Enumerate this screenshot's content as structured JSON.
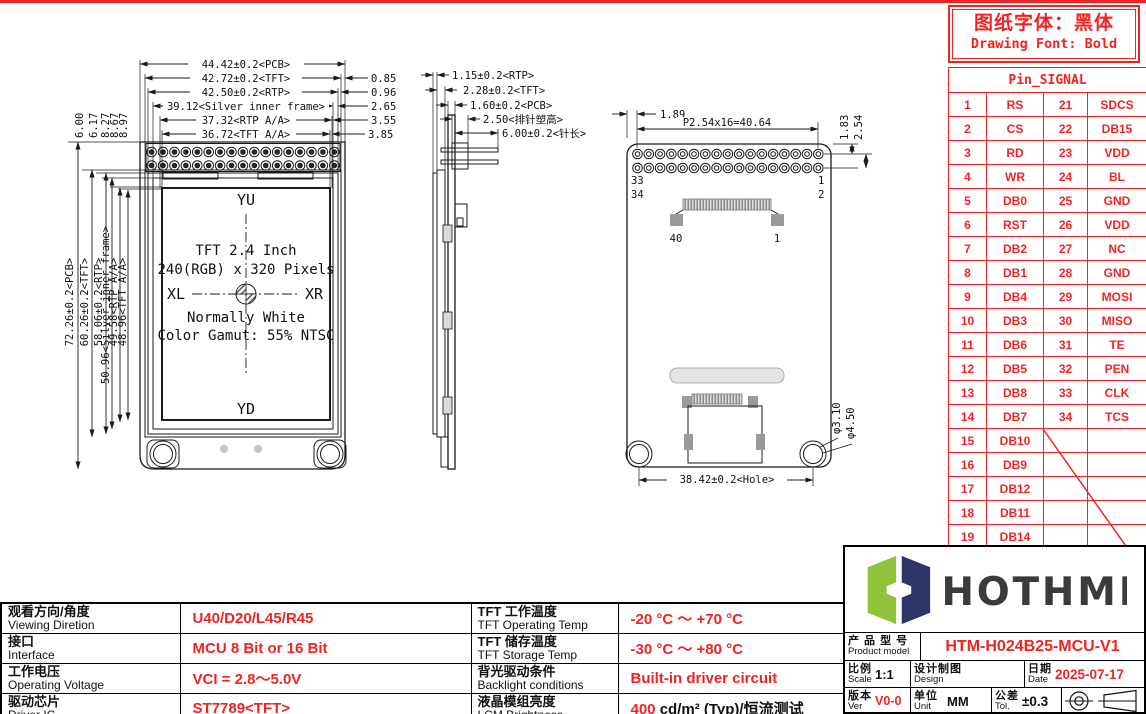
{
  "note_box": {
    "line1": "图纸字体：黑体",
    "line2": "Drawing Font: Bold"
  },
  "pin_table": {
    "title": "Pin_SIGNAL",
    "rows": [
      [
        "1",
        "RS",
        "21",
        "SDCS"
      ],
      [
        "2",
        "CS",
        "22",
        "DB15"
      ],
      [
        "3",
        "RD",
        "23",
        "VDD"
      ],
      [
        "4",
        "WR",
        "24",
        "BL"
      ],
      [
        "5",
        "DB0",
        "25",
        "GND"
      ],
      [
        "6",
        "RST",
        "26",
        "VDD"
      ],
      [
        "7",
        "DB2",
        "27",
        "NC"
      ],
      [
        "8",
        "DB1",
        "28",
        "GND"
      ],
      [
        "9",
        "DB4",
        "29",
        "MOSI"
      ],
      [
        "10",
        "DB3",
        "30",
        "MISO"
      ],
      [
        "11",
        "DB6",
        "31",
        "TE"
      ],
      [
        "12",
        "DB5",
        "32",
        "PEN"
      ],
      [
        "13",
        "DB8",
        "33",
        "CLK"
      ],
      [
        "14",
        "DB7",
        "34",
        "TCS"
      ],
      [
        "15",
        "DB10",
        "",
        ""
      ],
      [
        "16",
        "DB9",
        "",
        ""
      ],
      [
        "17",
        "DB12",
        "",
        ""
      ],
      [
        "18",
        "DB11",
        "",
        ""
      ],
      [
        "19",
        "DB14",
        "",
        ""
      ],
      [
        "20",
        "DB13",
        "",
        ""
      ]
    ]
  },
  "front_view": {
    "dim_pcb_w": "44.42±0.2<PCB>",
    "dim_tft_w": "42.72±0.2<TFT>",
    "dim_rtp_w": "42.50±0.2<RTP>",
    "dim_silver_w": "39.12<Silver inner frame>",
    "dim_rtp_aa_w": "37.32<RTP A/A>",
    "dim_tft_aa_w": "36.72<TFT A/A>",
    "off_tft": "0.85",
    "off_rtp": "0.96",
    "off_silver": "2.65",
    "off_rtp_aa": "3.55",
    "off_tft_aa": "3.85",
    "top_offsets": [
      "6.00",
      "6.17",
      "8.27",
      "8.67",
      "8.97"
    ],
    "dim_pcb_h": "72.26±0.2<PCB>",
    "dim_tft_h": "60.26±0.2<TFT>",
    "dim_rtp_h": "58.06±0.2<RTP>",
    "dim_silver_h": "50.96<Silver inner frame>",
    "dim_rtp_aa_h": "49.58<RTP A/A>",
    "dim_tft_aa_h": "48.96<TFT A/A>",
    "label_yu": "YU",
    "label_yd": "YD",
    "label_xl": "XL",
    "label_xr": "XR",
    "line1": "TFT 2.4 Inch",
    "line2": "240(RGB) x 320 Pixels",
    "line3": "Normally White",
    "line4": "Color Gamut: 55% NTSC"
  },
  "side_view": {
    "dim_rtp": "1.15±0.2<RTP>",
    "dim_tft": "2.28±0.2<TFT>",
    "dim_pcb": "1.60±0.2<PCB>",
    "dim_header": "2.50<排针塑高>",
    "dim_pin": "6.00±0.2<针长>"
  },
  "back_view": {
    "dim_edge": "1.89",
    "dim_pitch": "P2.54x16=40.64",
    "dim_row1": "1.83",
    "dim_row2": "2.54",
    "pin33": "33",
    "pin34": "34",
    "pin1": "1",
    "pin2": "2",
    "fpc40": "40",
    "fpc1": "1",
    "dim_hole_span": "38.42±0.2<Hole>",
    "dim_hole_inner": "φ3.10",
    "dim_hole_outer": "φ4.50"
  },
  "spec_table": {
    "col1": [
      {
        "cn": "观看方向/角度",
        "en": "Viewing Diretion",
        "value": "U40/D20/L45/R45"
      },
      {
        "cn": "接口",
        "en": "Interface",
        "value": "MCU 8 Bit or 16 Bit"
      },
      {
        "cn": "工作电压",
        "en": "Operating Voltage",
        "value": "VCI = 2.8～5.0V"
      },
      {
        "cn": "驱动芯片",
        "en": "Driver IC",
        "value": "ST7789<TFT>"
      }
    ],
    "col2": [
      {
        "cn": "TFT 工作温度",
        "en": "TFT Operating Temp",
        "value": "-20 °C ～ +70 °C"
      },
      {
        "cn": "TFT 储存温度",
        "en": "TFT Storage Temp",
        "value": "-30 °C ～ +80 °C"
      },
      {
        "cn": "背光驱动条件",
        "en": "Backlight conditions",
        "value": "Built-in driver circuit"
      },
      {
        "cn": "液晶模组亮度",
        "en": "LCM Brightness",
        "value_red": "400",
        "value_black": " cd/m² (Typ)/恒流测试"
      }
    ]
  },
  "title_block": {
    "brand": "HOTHMI",
    "product": {
      "cn": "产 品 型 号",
      "en": "Product model",
      "value": "HTM-H024B25-MCU-V1"
    },
    "scale": {
      "cn": "比例",
      "en": "Scale",
      "value": "1:1"
    },
    "design": {
      "cn": "设计制图",
      "en": "Design",
      "value": ""
    },
    "date": {
      "cn": "日期",
      "en": "Date",
      "value": "2025-07-17"
    },
    "ver": {
      "cn": "版本",
      "en": "Ver",
      "value": "V0-0"
    },
    "unit": {
      "cn": "单位",
      "en": "Unit",
      "value": "MM"
    },
    "tol": {
      "cn": "公差",
      "en": "Tol.",
      "value": "±0.3"
    }
  }
}
